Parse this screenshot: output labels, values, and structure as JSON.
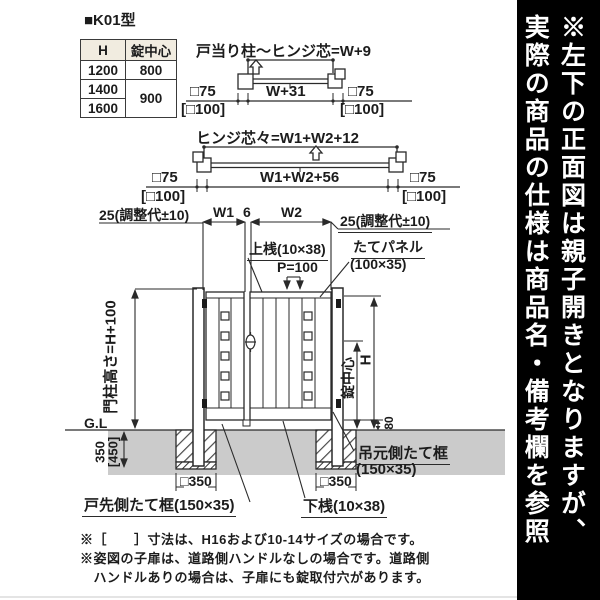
{
  "page": {
    "model": "■K01型"
  },
  "spec_table": {
    "header_h": "H",
    "header_lock": "錠中心",
    "r1_h": "1200",
    "r1_lock": "800",
    "r2_h": "1400",
    "r23_lock": "900",
    "r3_h": "1600"
  },
  "plan_top": {
    "title": "戸当り柱〜ヒンジ芯=W+9",
    "width_dim": "W+31",
    "left_post_size": "□75",
    "left_post_size_alt": "[□100]",
    "right_post_size": "□75",
    "right_post_size_alt": "[□100]"
  },
  "plan_mid": {
    "title": "ヒンジ芯々=W1+W2+12",
    "width_dim": "W1+W2+56",
    "left_post_size": "□75",
    "left_post_size_alt": "[□100]",
    "right_post_size": "□75",
    "right_post_size_alt": "[□100]"
  },
  "front_view": {
    "adjust_left": "25(調整代±10)",
    "w1": "W1",
    "gap": "6",
    "w2": "W2",
    "adjust_right": "25(調整代±10)",
    "top_rail": "上桟(10×38)",
    "pitch": "P=100",
    "panel_line1": "たてパネル",
    "panel_line2": "(100×35)",
    "post_height": "門柱高さ=H+100",
    "ground_level": "G.L",
    "lock_center": "錠中心",
    "height": "H",
    "bottom_clearance": "80",
    "embed_depth": "350",
    "embed_depth_alt": "[450]",
    "footing_left": "□350",
    "footing_right": "□350",
    "latch_stile": "戸先側たて框(150×35)",
    "hinge_stile_line1": "吊元側たて框",
    "hinge_stile_line2": "(150×35)",
    "bottom_rail": "下桟(10×38)"
  },
  "notes": {
    "line1": "※［　　］寸法は、H16および10-14サイズの場合です。",
    "line2": "※姿図の子扉は、道路側ハンドルなしの場合です。道路側",
    "line3": "　ハンドルありの場合は、子扉にも錠取付穴があります。"
  },
  "sidebar": {
    "text_line1": "※左下の正面図は親子開きとなりますが、",
    "text_line2": "実際の商品の仕様は商品名・備考欄を参照"
  },
  "colors": {
    "line": "#2a2a2a",
    "ground_fill": "#cbcbcb",
    "table_header_bg": "#f1ece0",
    "sidebar_bg": "#000000",
    "sidebar_fg": "#ffffff"
  }
}
